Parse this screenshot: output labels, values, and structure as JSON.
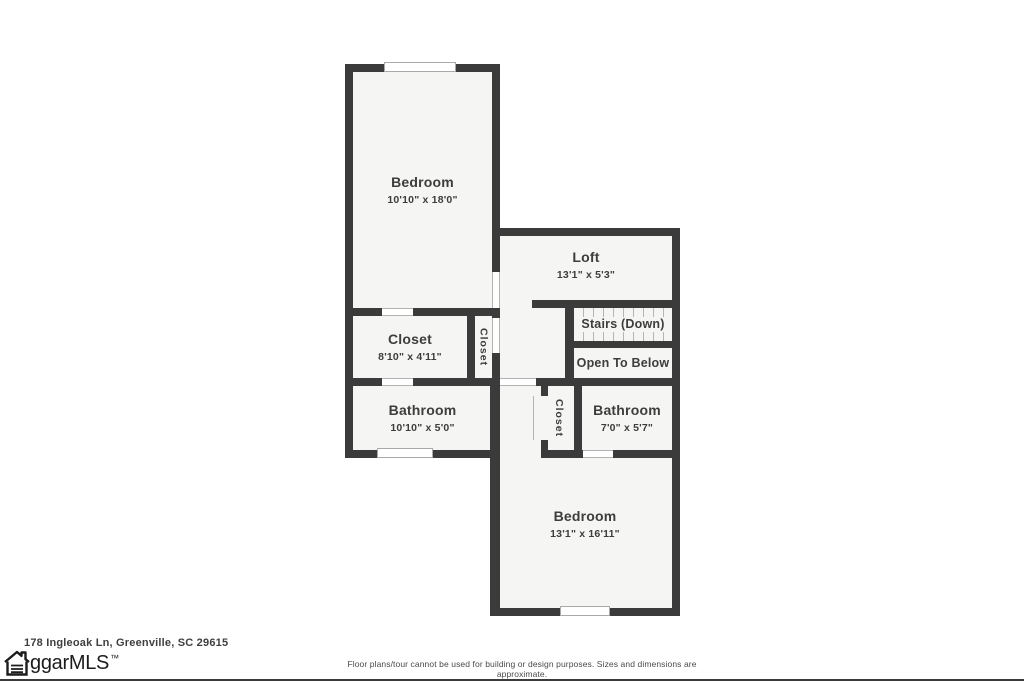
{
  "floor_plan": {
    "rooms": {
      "bedroom_upper": {
        "name": "Bedroom",
        "dims": "10'10\" x 18'0\""
      },
      "loft": {
        "name": "Loft",
        "dims": "13'1\" x 5'3\""
      },
      "stairs": {
        "name": "Stairs (Down)"
      },
      "open_to_below": {
        "name": "Open To Below"
      },
      "walk_in_closet": {
        "name": "Closet",
        "dims": "8'10\" x 4'11\""
      },
      "hall_closet": {
        "name": "Closet"
      },
      "bathroom_left": {
        "name": "Bathroom",
        "dims": "10'10\" x 5'0\""
      },
      "bedroom_closet": {
        "name": "Closet"
      },
      "bathroom_right": {
        "name": "Bathroom",
        "dims": "7'0\" x 5'7\""
      },
      "bedroom_lower": {
        "name": "Bedroom",
        "dims": "13'1\" x 16'11\""
      }
    }
  },
  "footer": {
    "address": "178 Ingleoak Ln, Greenville, SC 29615",
    "logo_text": "ggarMLS",
    "logo_tm": "™",
    "disclaimer": "Floor plans/tour cannot be used for building or design purposes. Sizes and dimensions are approximate."
  },
  "colors": {
    "wall": "#3b3b3b",
    "room_fill": "#f5f5f3",
    "opening_line": "#b3b3b3",
    "text": "#3d3d3d",
    "background": "#ffffff"
  }
}
